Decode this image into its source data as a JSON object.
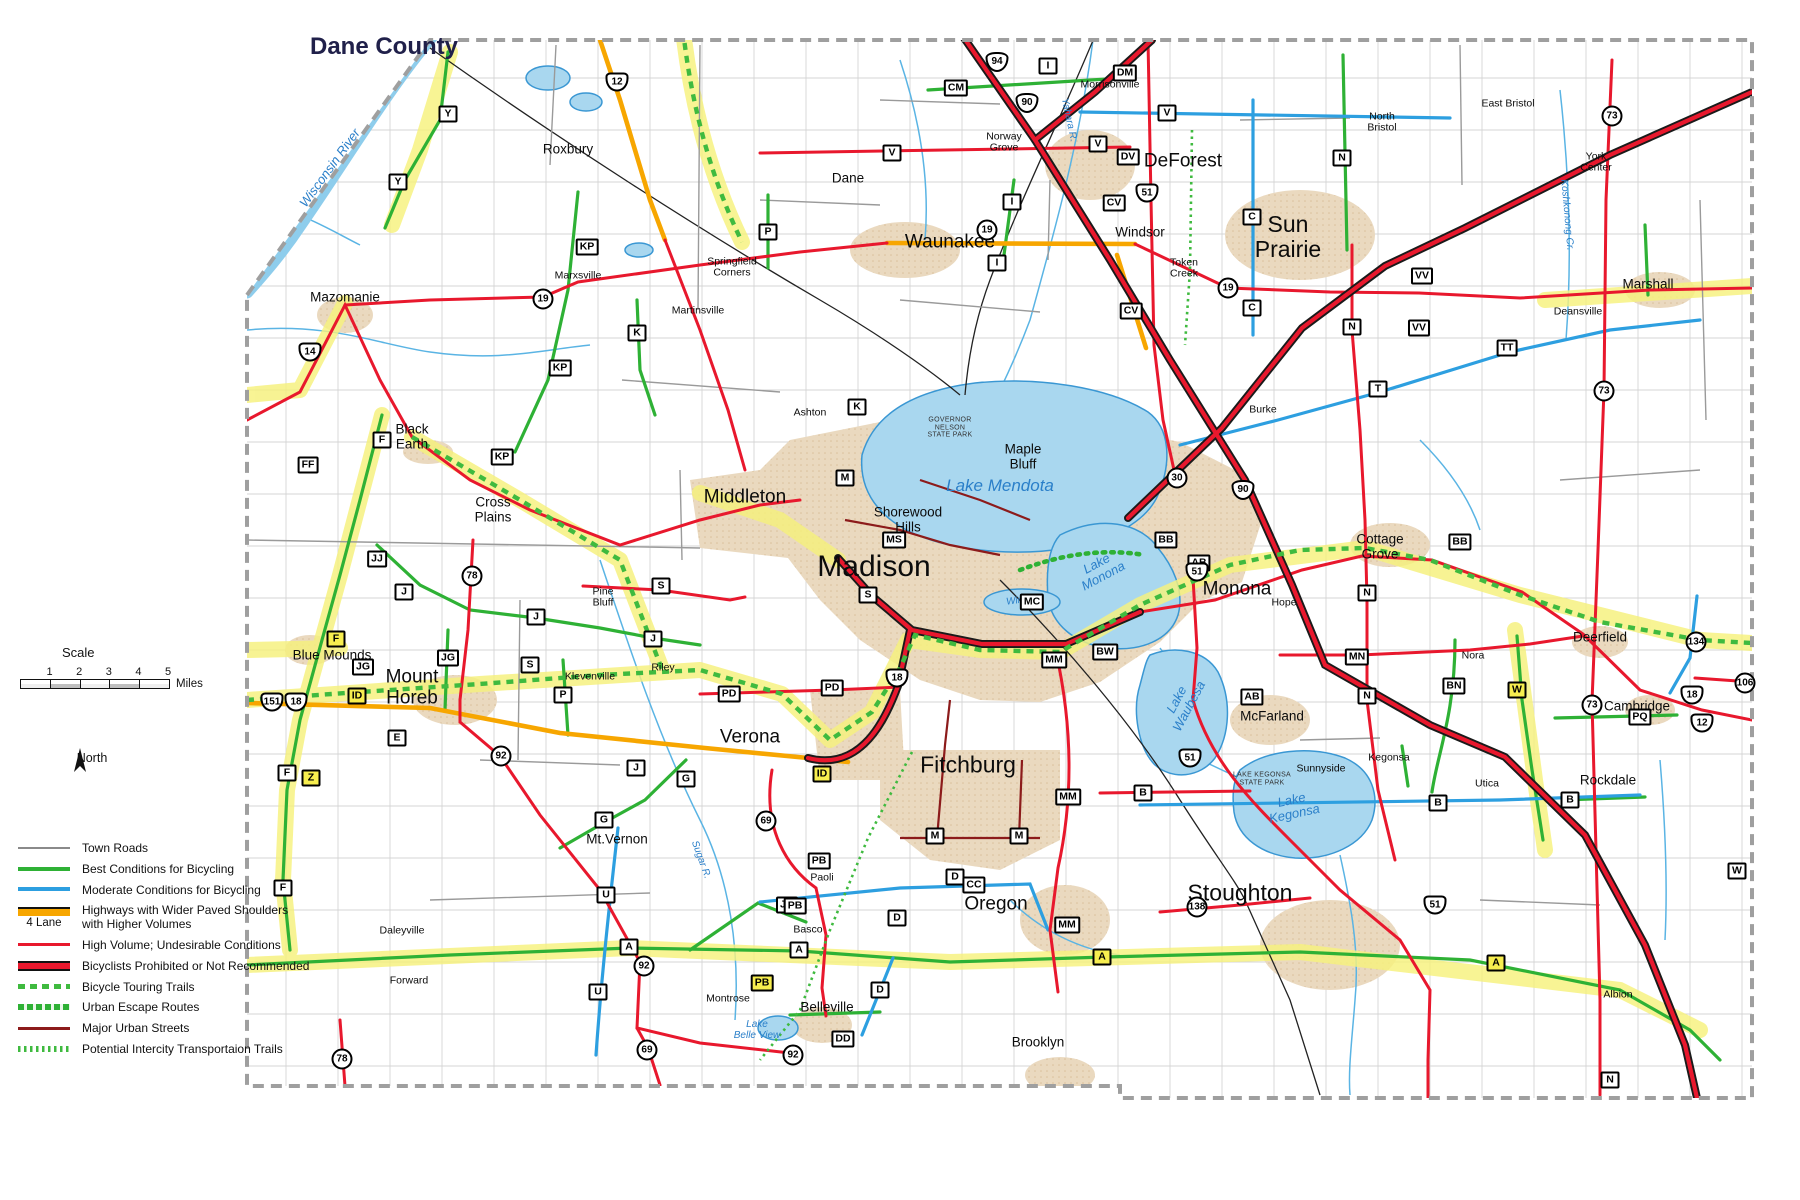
{
  "title": "Dane County",
  "scale": {
    "label": "Scale",
    "ticks": [
      {
        "v": "1"
      },
      {
        "v": "2"
      },
      {
        "v": "3"
      },
      {
        "v": "4"
      },
      {
        "v": "5"
      }
    ],
    "unit": "Miles"
  },
  "north_label": "North",
  "legend": {
    "items": [
      {
        "label": "Town Roads",
        "cls": "row-town"
      },
      {
        "label": "Best Conditions for Bicycling",
        "cls": "row-best"
      },
      {
        "label": "Moderate Conditions for Bicycling",
        "cls": "row-moderate"
      },
      {
        "label": "Highways with Wider Paved Shoulders\nwith Higher Volumes",
        "cls": "row-shoulders",
        "note": "4 Lane"
      },
      {
        "label": "High Volume;  Undesirable Conditions",
        "cls": "row-high"
      },
      {
        "label": "Bicyclists Prohibited or Not Recommended",
        "cls": "row-prohibited"
      },
      {
        "label": "Bicycle Touring Trails",
        "cls": "row-touring"
      },
      {
        "label": "Urban Escape Routes",
        "cls": "row-escape"
      },
      {
        "label": "Major Urban Streets",
        "cls": "row-major"
      },
      {
        "label": "Potential Intercity Transportaion Trails",
        "cls": "row-potential"
      }
    ]
  },
  "colors": {
    "best": "#2eb135",
    "moderate": "#2d9fe0",
    "shoulders": "#f7a600",
    "high_volume": "#e8182d",
    "prohibited_casing": "#1a1a1a",
    "major_urban": "#8c1b1b",
    "route_highlight": "#f6f17c",
    "lake": "#a9d7ef",
    "urban_area": "#ead9bf"
  },
  "labels": [
    {
      "text": "Madison",
      "x": 874,
      "y": 567,
      "cls": "xl"
    },
    {
      "text": "Sun\nPrairie",
      "x": 1288,
      "y": 237,
      "cls": "lg"
    },
    {
      "text": "Fitchburg",
      "x": 968,
      "y": 765,
      "cls": "lg"
    },
    {
      "text": "Stoughton",
      "x": 1240,
      "y": 893,
      "cls": "lg"
    },
    {
      "text": "Middleton",
      "x": 745,
      "y": 498,
      "cls": "lg2"
    },
    {
      "text": "Monona",
      "x": 1237,
      "y": 590,
      "cls": "lg2"
    },
    {
      "text": "Verona",
      "x": 750,
      "y": 738,
      "cls": "lg2"
    },
    {
      "text": "Oregon",
      "x": 996,
      "y": 905,
      "cls": "lg2"
    },
    {
      "text": "Waunakee",
      "x": 950,
      "y": 243,
      "cls": "lg2"
    },
    {
      "text": "DeForest",
      "x": 1183,
      "y": 162,
      "cls": "lg2"
    },
    {
      "text": "Mount\nHoreb",
      "x": 412,
      "y": 688,
      "cls": "lg2"
    },
    {
      "text": "Mazomanie",
      "x": 345,
      "y": 298,
      "cls": "md"
    },
    {
      "text": "Black\nEarth",
      "x": 412,
      "y": 437,
      "cls": "md"
    },
    {
      "text": "Cross\nPlains",
      "x": 493,
      "y": 510,
      "cls": "md"
    },
    {
      "text": "Blue Mounds",
      "x": 332,
      "y": 656,
      "cls": "md"
    },
    {
      "text": "Mt.Vernon",
      "x": 617,
      "y": 840,
      "cls": "md"
    },
    {
      "text": "Belleville",
      "x": 827,
      "y": 1008,
      "cls": "md"
    },
    {
      "text": "Brooklyn",
      "x": 1038,
      "y": 1043,
      "cls": "md"
    },
    {
      "text": "McFarland",
      "x": 1272,
      "y": 717,
      "cls": "md"
    },
    {
      "text": "Cottage\nGrove",
      "x": 1380,
      "y": 547,
      "cls": "md"
    },
    {
      "text": "Deerfield",
      "x": 1600,
      "y": 638,
      "cls": "md"
    },
    {
      "text": "Cambridge",
      "x": 1637,
      "y": 707,
      "cls": "md"
    },
    {
      "text": "Rockdale",
      "x": 1608,
      "y": 781,
      "cls": "md"
    },
    {
      "text": "Marshall",
      "x": 1648,
      "y": 285,
      "cls": "md"
    },
    {
      "text": "Windsor",
      "x": 1140,
      "y": 233,
      "cls": "md"
    },
    {
      "text": "Maple\nBluff",
      "x": 1023,
      "y": 457,
      "cls": "md"
    },
    {
      "text": "Shorewood\nHills",
      "x": 908,
      "y": 520,
      "cls": "md"
    },
    {
      "text": "Dane",
      "x": 848,
      "y": 179,
      "cls": "md"
    },
    {
      "text": "Roxbury",
      "x": 568,
      "y": 150,
      "cls": "md"
    },
    {
      "text": "Marxsville",
      "x": 578,
      "y": 276,
      "cls": "sm"
    },
    {
      "text": "Martinsville",
      "x": 698,
      "y": 311,
      "cls": "sm"
    },
    {
      "text": "Springfield\nCorners",
      "x": 732,
      "y": 268,
      "cls": "sm"
    },
    {
      "text": "Ashton",
      "x": 810,
      "y": 413,
      "cls": "sm"
    },
    {
      "text": "Pine\nBluff",
      "x": 603,
      "y": 598,
      "cls": "sm"
    },
    {
      "text": "Riley",
      "x": 663,
      "y": 668,
      "cls": "sm"
    },
    {
      "text": "Klevenville",
      "x": 590,
      "y": 677,
      "cls": "sm"
    },
    {
      "text": "Paoli",
      "x": 822,
      "y": 878,
      "cls": "sm"
    },
    {
      "text": "Basco",
      "x": 808,
      "y": 930,
      "cls": "sm"
    },
    {
      "text": "Montrose",
      "x": 728,
      "y": 999,
      "cls": "sm"
    },
    {
      "text": "Daleyville",
      "x": 402,
      "y": 931,
      "cls": "sm"
    },
    {
      "text": "Forward",
      "x": 409,
      "y": 981,
      "cls": "sm"
    },
    {
      "text": "Norway\nGrove",
      "x": 1004,
      "y": 143,
      "cls": "sm"
    },
    {
      "text": "Morrisonville",
      "x": 1110,
      "y": 85,
      "cls": "sm"
    },
    {
      "text": "Token\nCreek",
      "x": 1184,
      "y": 269,
      "cls": "sm"
    },
    {
      "text": "Burke",
      "x": 1263,
      "y": 410,
      "cls": "sm"
    },
    {
      "text": "North\nBristol",
      "x": 1382,
      "y": 123,
      "cls": "sm"
    },
    {
      "text": "East Bristol",
      "x": 1508,
      "y": 104,
      "cls": "sm"
    },
    {
      "text": "York\nCenter",
      "x": 1596,
      "y": 163,
      "cls": "sm"
    },
    {
      "text": "Deansville",
      "x": 1578,
      "y": 312,
      "cls": "sm"
    },
    {
      "text": "Hope",
      "x": 1284,
      "y": 603,
      "cls": "sm"
    },
    {
      "text": "Nora",
      "x": 1473,
      "y": 656,
      "cls": "sm"
    },
    {
      "text": "Utica",
      "x": 1487,
      "y": 784,
      "cls": "sm"
    },
    {
      "text": "Kegonsa",
      "x": 1389,
      "y": 758,
      "cls": "sm"
    },
    {
      "text": "Sunnyside",
      "x": 1321,
      "y": 769,
      "cls": "sm"
    },
    {
      "text": "Albion",
      "x": 1618,
      "y": 995,
      "cls": "sm"
    },
    {
      "text": "Lake   Mendota",
      "x": 1000,
      "y": 486,
      "cls": "lake-lg"
    },
    {
      "text": "Lake\nMonona",
      "x": 1100,
      "y": 570,
      "cls": "lake",
      "rot": -28
    },
    {
      "text": "Lake\nWaubesa",
      "x": 1183,
      "y": 703,
      "cls": "lake",
      "rot": -62
    },
    {
      "text": "Lake\nKegonsa",
      "x": 1293,
      "y": 807,
      "cls": "lake",
      "rot": -12
    },
    {
      "text": "Lake\nBelle View",
      "x": 757,
      "y": 1031,
      "cls": "lake-sm"
    },
    {
      "text": "Wingra",
      "x": 1022,
      "y": 601,
      "cls": "lake-sm",
      "rot": -8
    },
    {
      "text": "Wisconsin  River",
      "x": 330,
      "y": 168,
      "cls": "lake",
      "rot": -54
    },
    {
      "text": "Yahara  R.",
      "x": 1068,
      "y": 120,
      "cls": "river",
      "rot": 78
    },
    {
      "text": "Sugar  R.",
      "x": 700,
      "y": 860,
      "cls": "river",
      "rot": 70
    },
    {
      "text": "Koshkonong  Cr.",
      "x": 1566,
      "y": 215,
      "cls": "river",
      "rot": 85
    },
    {
      "text": "GOVERNOR\nNELSON\nSTATE PARK",
      "x": 950,
      "y": 428,
      "cls": "park"
    },
    {
      "text": "LAKE KEGONSA\nSTATE PARK",
      "x": 1262,
      "y": 779,
      "cls": "park"
    }
  ],
  "shields": [
    {
      "label": "Y",
      "cls": "co",
      "x": 448,
      "y": 114
    },
    {
      "label": "Y",
      "cls": "co",
      "x": 398,
      "y": 182
    },
    {
      "label": "KP",
      "cls": "co",
      "x": 587,
      "y": 247
    },
    {
      "label": "KP",
      "cls": "co",
      "x": 560,
      "y": 368
    },
    {
      "label": "KP",
      "cls": "co",
      "x": 502,
      "y": 457
    },
    {
      "label": "P",
      "cls": "co",
      "x": 768,
      "y": 232
    },
    {
      "label": "P",
      "cls": "co",
      "x": 563,
      "y": 695
    },
    {
      "label": "K",
      "cls": "co",
      "x": 637,
      "y": 333
    },
    {
      "label": "K",
      "cls": "co",
      "x": 857,
      "y": 407
    },
    {
      "label": "M",
      "cls": "co",
      "x": 845,
      "y": 478
    },
    {
      "label": "M",
      "cls": "co",
      "x": 935,
      "y": 836
    },
    {
      "label": "M",
      "cls": "co",
      "x": 1019,
      "y": 836
    },
    {
      "label": "MS",
      "cls": "co",
      "x": 894,
      "y": 540
    },
    {
      "label": "S",
      "cls": "co",
      "x": 868,
      "y": 595
    },
    {
      "label": "S",
      "cls": "co",
      "x": 661,
      "y": 586
    },
    {
      "label": "S",
      "cls": "co",
      "x": 530,
      "y": 665
    },
    {
      "label": "JJ",
      "cls": "co",
      "x": 377,
      "y": 559
    },
    {
      "label": "J",
      "cls": "co",
      "x": 404,
      "y": 592
    },
    {
      "label": "J",
      "cls": "co",
      "x": 536,
      "y": 617
    },
    {
      "label": "J",
      "cls": "co",
      "x": 653,
      "y": 639
    },
    {
      "label": "J",
      "cls": "co",
      "x": 636,
      "y": 768
    },
    {
      "label": "JG",
      "cls": "co",
      "x": 448,
      "y": 658
    },
    {
      "label": "JG",
      "cls": "co",
      "x": 363,
      "y": 667
    },
    {
      "label": "JG",
      "cls": "co",
      "x": 787,
      "y": 905
    },
    {
      "label": "G",
      "cls": "co",
      "x": 686,
      "y": 779
    },
    {
      "label": "G",
      "cls": "co",
      "x": 604,
      "y": 820
    },
    {
      "label": "U",
      "cls": "co",
      "x": 606,
      "y": 895
    },
    {
      "label": "U",
      "cls": "co",
      "x": 598,
      "y": 992
    },
    {
      "label": "E",
      "cls": "co",
      "x": 397,
      "y": 738
    },
    {
      "label": "F",
      "cls": "co",
      "x": 382,
      "y": 440
    },
    {
      "label": "F",
      "cls": "co",
      "x": 287,
      "y": 773
    },
    {
      "label": "F",
      "cls": "co",
      "x": 283,
      "y": 888
    },
    {
      "label": "FF",
      "cls": "co",
      "x": 308,
      "y": 465
    },
    {
      "label": "A",
      "cls": "co",
      "x": 629,
      "y": 947
    },
    {
      "label": "A",
      "cls": "co",
      "x": 799,
      "y": 950
    },
    {
      "label": "B",
      "cls": "co",
      "x": 1143,
      "y": 793
    },
    {
      "label": "B",
      "cls": "co",
      "x": 1438,
      "y": 803
    },
    {
      "label": "B",
      "cls": "co",
      "x": 1570,
      "y": 800
    },
    {
      "label": "BB",
      "cls": "co",
      "x": 1166,
      "y": 540
    },
    {
      "label": "BB",
      "cls": "co",
      "x": 1460,
      "y": 542
    },
    {
      "label": "BN",
      "cls": "co",
      "x": 1454,
      "y": 686
    },
    {
      "label": "BW",
      "cls": "co",
      "x": 1105,
      "y": 652
    },
    {
      "label": "MC",
      "cls": "co",
      "x": 1032,
      "y": 602
    },
    {
      "label": "MM",
      "cls": "co",
      "x": 1054,
      "y": 660
    },
    {
      "label": "MM",
      "cls": "co",
      "x": 1068,
      "y": 797
    },
    {
      "label": "MM",
      "cls": "co",
      "x": 1067,
      "y": 925
    },
    {
      "label": "MN",
      "cls": "co",
      "x": 1357,
      "y": 657
    },
    {
      "label": "N",
      "cls": "co",
      "x": 1342,
      "y": 158
    },
    {
      "label": "N",
      "cls": "co",
      "x": 1352,
      "y": 327
    },
    {
      "label": "N",
      "cls": "co",
      "x": 1367,
      "y": 593
    },
    {
      "label": "N",
      "cls": "co",
      "x": 1367,
      "y": 696
    },
    {
      "label": "N",
      "cls": "co",
      "x": 1610,
      "y": 1080
    },
    {
      "label": "T",
      "cls": "co",
      "x": 1378,
      "y": 389
    },
    {
      "label": "TT",
      "cls": "co",
      "x": 1507,
      "y": 348
    },
    {
      "label": "VV",
      "cls": "co",
      "x": 1422,
      "y": 276
    },
    {
      "label": "VV",
      "cls": "co",
      "x": 1419,
      "y": 328
    },
    {
      "label": "V",
      "cls": "co",
      "x": 892,
      "y": 153
    },
    {
      "label": "V",
      "cls": "co",
      "x": 1098,
      "y": 144
    },
    {
      "label": "V",
      "cls": "co",
      "x": 1167,
      "y": 113
    },
    {
      "label": "CV",
      "cls": "co",
      "x": 1114,
      "y": 203
    },
    {
      "label": "CV",
      "cls": "co",
      "x": 1131,
      "y": 311
    },
    {
      "label": "DV",
      "cls": "co",
      "x": 1128,
      "y": 157
    },
    {
      "label": "CM",
      "cls": "co",
      "x": 956,
      "y": 88
    },
    {
      "label": "DM",
      "cls": "co",
      "x": 1125,
      "y": 73
    },
    {
      "label": "I",
      "cls": "co",
      "x": 1048,
      "y": 66
    },
    {
      "label": "I",
      "cls": "co",
      "x": 1012,
      "y": 202
    },
    {
      "label": "I",
      "cls": "co",
      "x": 997,
      "y": 263
    },
    {
      "label": "W",
      "cls": "co",
      "x": 1737,
      "y": 871
    },
    {
      "label": "PD",
      "cls": "co",
      "x": 729,
      "y": 694
    },
    {
      "label": "PD",
      "cls": "co",
      "x": 832,
      "y": 688
    },
    {
      "label": "PB",
      "cls": "co",
      "x": 819,
      "y": 861
    },
    {
      "label": "PB",
      "cls": "co",
      "x": 795,
      "y": 906
    },
    {
      "label": "PQ",
      "cls": "co",
      "x": 1640,
      "y": 717
    },
    {
      "label": "D",
      "cls": "co",
      "x": 955,
      "y": 877
    },
    {
      "label": "D",
      "cls": "co",
      "x": 897,
      "y": 918
    },
    {
      "label": "D",
      "cls": "co",
      "x": 880,
      "y": 990
    },
    {
      "label": "DD",
      "cls": "co",
      "x": 843,
      "y": 1039
    },
    {
      "label": "CC",
      "cls": "co",
      "x": 974,
      "y": 885
    },
    {
      "label": "AB",
      "cls": "co",
      "x": 1199,
      "y": 563
    },
    {
      "label": "AB",
      "cls": "co",
      "x": 1252,
      "y": 697
    },
    {
      "label": "C",
      "cls": "co",
      "x": 1252,
      "y": 217
    },
    {
      "label": "C",
      "cls": "co",
      "x": 1252,
      "y": 308
    },
    {
      "label": "F",
      "cls": "coy",
      "x": 336,
      "y": 639
    },
    {
      "label": "Z",
      "cls": "coy",
      "x": 311,
      "y": 778
    },
    {
      "label": "ID",
      "cls": "coy",
      "x": 357,
      "y": 696
    },
    {
      "label": "ID",
      "cls": "coy",
      "x": 822,
      "y": 774
    },
    {
      "label": "A",
      "cls": "coy",
      "x": 1102,
      "y": 957
    },
    {
      "label": "A",
      "cls": "coy",
      "x": 1496,
      "y": 963
    },
    {
      "label": "W",
      "cls": "coy",
      "x": 1517,
      "y": 690
    },
    {
      "label": "PB",
      "cls": "coy",
      "x": 762,
      "y": 983
    },
    {
      "label": "19",
      "cls": "st",
      "x": 543,
      "y": 299
    },
    {
      "label": "19",
      "cls": "st",
      "x": 987,
      "y": 230
    },
    {
      "label": "19",
      "cls": "st",
      "x": 1228,
      "y": 288
    },
    {
      "label": "78",
      "cls": "st",
      "x": 472,
      "y": 576
    },
    {
      "label": "78",
      "cls": "st",
      "x": 342,
      "y": 1059
    },
    {
      "label": "92",
      "cls": "st",
      "x": 501,
      "y": 756
    },
    {
      "label": "92",
      "cls": "st",
      "x": 644,
      "y": 966
    },
    {
      "label": "92",
      "cls": "st",
      "x": 793,
      "y": 1055
    },
    {
      "label": "69",
      "cls": "st",
      "x": 766,
      "y": 821
    },
    {
      "label": "69",
      "cls": "st",
      "x": 647,
      "y": 1050
    },
    {
      "label": "73",
      "cls": "st",
      "x": 1612,
      "y": 116
    },
    {
      "label": "73",
      "cls": "st",
      "x": 1604,
      "y": 391
    },
    {
      "label": "73",
      "cls": "st",
      "x": 1592,
      "y": 705
    },
    {
      "label": "134",
      "cls": "st",
      "x": 1696,
      "y": 642
    },
    {
      "label": "138",
      "cls": "st",
      "x": 1197,
      "y": 907
    },
    {
      "label": "106",
      "cls": "st",
      "x": 1745,
      "y": 683
    },
    {
      "label": "30",
      "cls": "st",
      "x": 1177,
      "y": 478
    },
    {
      "label": "14",
      "cls": "us",
      "x": 310,
      "y": 352
    },
    {
      "label": "12",
      "cls": "us",
      "x": 617,
      "y": 82
    },
    {
      "label": "151",
      "cls": "us",
      "x": 272,
      "y": 702
    },
    {
      "label": "18",
      "cls": "us",
      "x": 296,
      "y": 702
    },
    {
      "label": "51",
      "cls": "us",
      "x": 1147,
      "y": 193
    },
    {
      "label": "51",
      "cls": "us",
      "x": 1197,
      "y": 572
    },
    {
      "label": "51",
      "cls": "us",
      "x": 1190,
      "y": 758
    },
    {
      "label": "51",
      "cls": "us",
      "x": 1435,
      "y": 905
    },
    {
      "label": "18",
      "cls": "us",
      "x": 897,
      "y": 678
    },
    {
      "label": "18",
      "cls": "us",
      "x": 1692,
      "y": 695
    },
    {
      "label": "12",
      "cls": "us",
      "x": 1702,
      "y": 723
    },
    {
      "label": "94",
      "cls": "is",
      "x": 997,
      "y": 62
    },
    {
      "label": "90",
      "cls": "is",
      "x": 1027,
      "y": 103
    },
    {
      "label": "90",
      "cls": "is",
      "x": 1243,
      "y": 490
    }
  ]
}
